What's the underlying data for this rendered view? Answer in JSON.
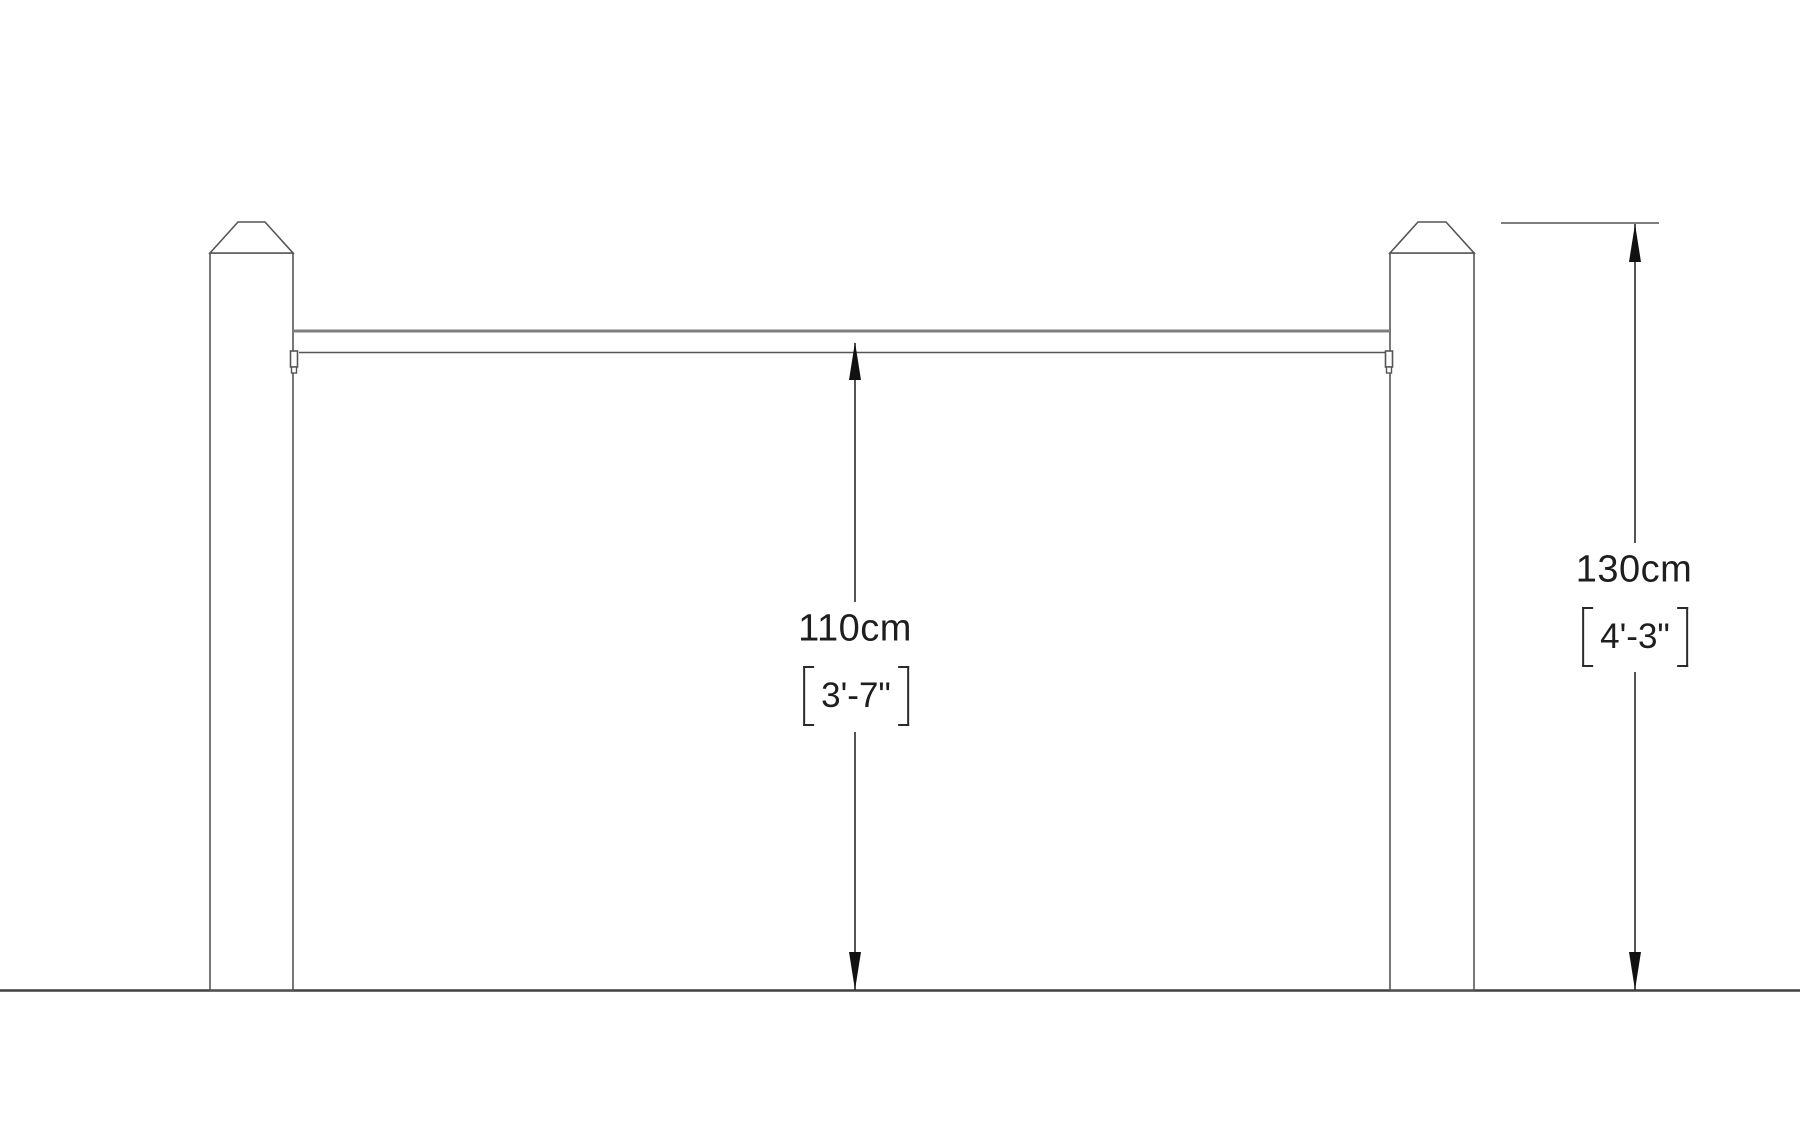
{
  "diagram": {
    "kind": "fence-post-and-rail-elevation",
    "labels": {
      "rail_height_cm": "110cm",
      "rail_height_imperial": "3'-7\"",
      "post_height_cm": "130cm",
      "post_height_imperial": "4'-3\""
    },
    "colors": {
      "outline": "#555555",
      "rail_top": "#7f7f7f",
      "ground": "#404040",
      "arrow": "#111111",
      "text": "#1e1e1e",
      "background": "#ffffff"
    }
  }
}
